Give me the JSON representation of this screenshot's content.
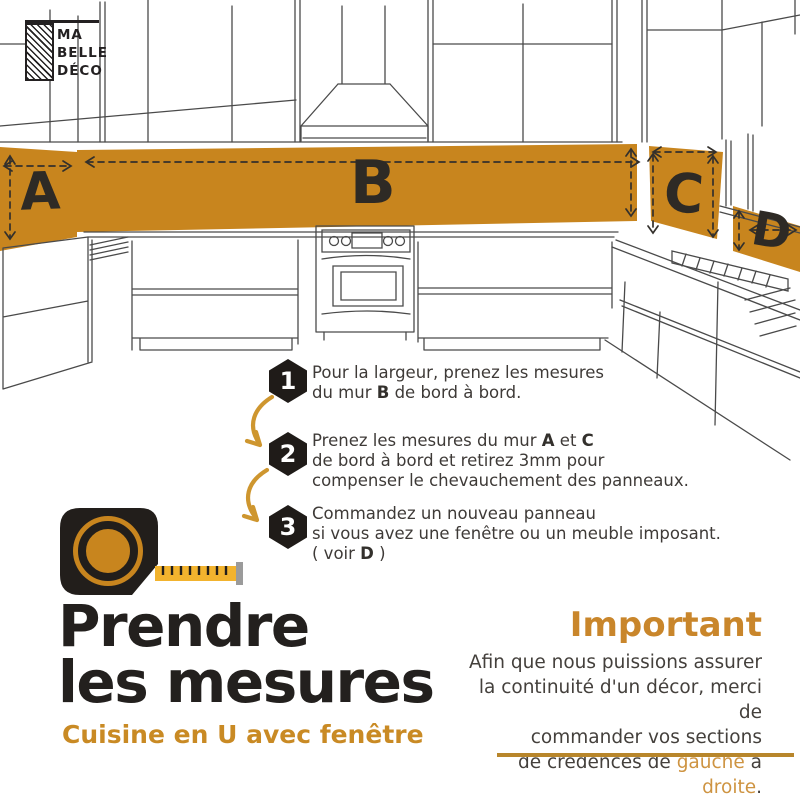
{
  "brand": {
    "line1": "MA",
    "line2": "BELLE",
    "line3": "DÉCO"
  },
  "zones": {
    "a": "A",
    "b": "B",
    "c": "C",
    "d": "D"
  },
  "steps": [
    {
      "num": "1",
      "l1": "Pour la largeur, prenez les mesures",
      "l2a": "du mur ",
      "l2b": "B",
      "l2c": " de bord à bord."
    },
    {
      "num": "2",
      "l1a": "Prenez les mesures du mur ",
      "l1b": "A",
      "l1c": " et ",
      "l1d": "C",
      "l2": "de bord à bord et retirez 3mm pour",
      "l3": "compenser le chevauchement des panneaux."
    },
    {
      "num": "3",
      "l1": "Commandez un nouveau panneau",
      "l2": "si vous avez une fenêtre ou un meuble imposant.",
      "l3a": "( voir ",
      "l3b": "D",
      "l3c": " )"
    }
  ],
  "title": {
    "line1": "Prendre",
    "line2": "les mesures"
  },
  "subtitle": "Cuisine en U avec fenêtre",
  "important": {
    "heading": "Important",
    "l1": "Afin que nous puissions assurer",
    "l2": "la continuité d'un décor, merci de",
    "l3": "commander vos sections",
    "l4a": "de crédences de ",
    "l4b": "gauche",
    "l4c": " à ",
    "l4d": "droite",
    "l4e": "."
  },
  "colors": {
    "band_orange": "#C8851E",
    "accent_orange": "#C98A24",
    "tape_yellow": "#F2B32E",
    "arrow_orange": "#CE962F",
    "rule_gold": "#B8862B",
    "ink_dark": "#232021",
    "text_gray": "#3E3A37"
  }
}
